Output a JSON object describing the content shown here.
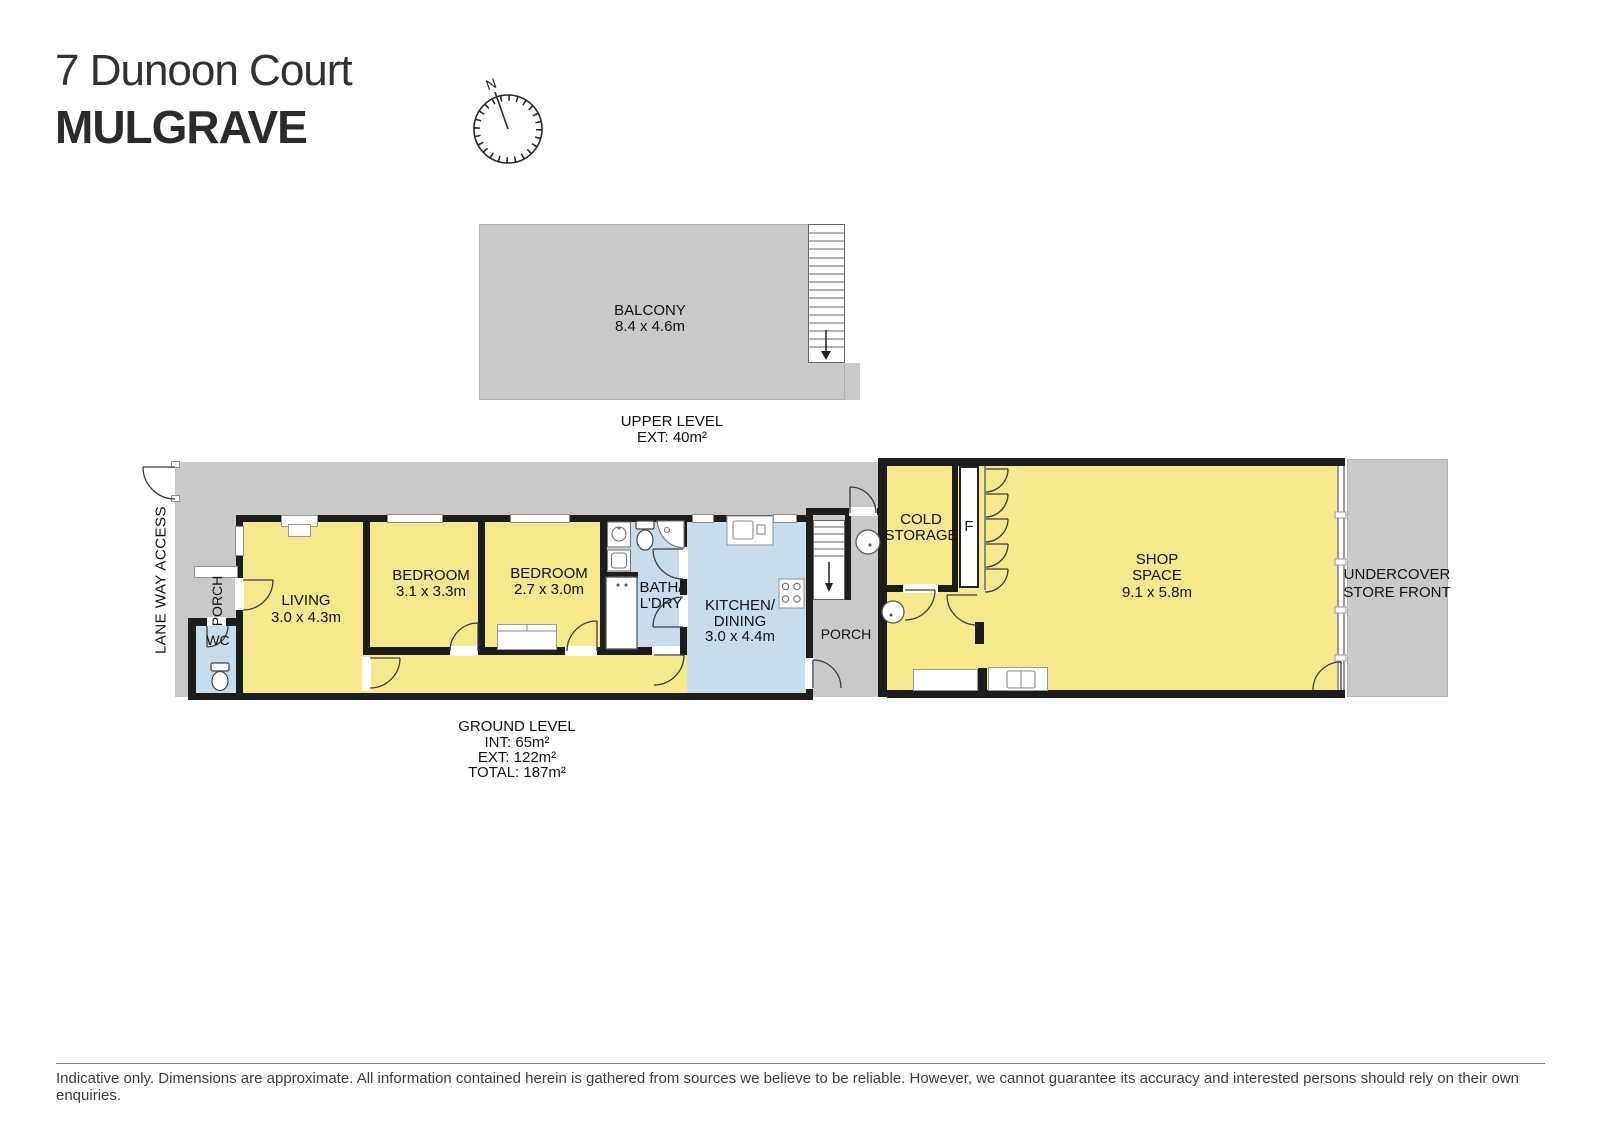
{
  "title": {
    "line1": "7 Dunoon Court",
    "line2": "MULGRAVE"
  },
  "compass": {
    "north": "N"
  },
  "upper_level": {
    "balcony": {
      "name": "BALCONY",
      "dims": "8.4 x 4.6m"
    },
    "caption": {
      "line1": "UPPER LEVEL",
      "line2": "EXT: 40m²"
    }
  },
  "ground_level": {
    "laneway_label": "LANE WAY ACCESS",
    "porch_left_label": "PORCH",
    "porch_mid_label": "PORCH",
    "wc_label": "WC",
    "living": {
      "name": "LIVING",
      "dims": "3.0 x 4.3m"
    },
    "bedroom1": {
      "name": "BEDROOM",
      "dims": "3.1 x 3.3m"
    },
    "bedroom2": {
      "name": "BEDROOM",
      "dims": "2.7 x 3.0m"
    },
    "bath": {
      "line1": "BATH/",
      "line2": "L'DRY"
    },
    "kitchen": {
      "line1": "KITCHEN/",
      "line2": "DINING",
      "dims": "3.0 x 4.4m"
    },
    "cold_storage": {
      "line1": "COLD",
      "line2": "STORAGE"
    },
    "freezer_label": "F",
    "shop": {
      "line1": "SHOP",
      "line2": "SPACE",
      "dims": "9.1 x 5.8m"
    },
    "undercover": {
      "line1": "UNDERCOVER",
      "line2": "STORE FRONT"
    },
    "caption": {
      "line1": "GROUND LEVEL",
      "line2": "INT: 65m²",
      "line3": "EXT: 122m²",
      "line4": "TOTAL: 187m²"
    }
  },
  "footer": {
    "disclaimer": "Indicative only. Dimensions are approximate. All information contained herein is gathered from sources we believe to be reliable. However, we cannot guarantee its accuracy and interested persons should rely on their own enquiries."
  },
  "colors": {
    "interior_yellow": "#f6e88d",
    "wet_area_blue": "#c9dcec",
    "exterior_grey": "#c9c9c9",
    "wall_black": "#1d1d1d"
  }
}
